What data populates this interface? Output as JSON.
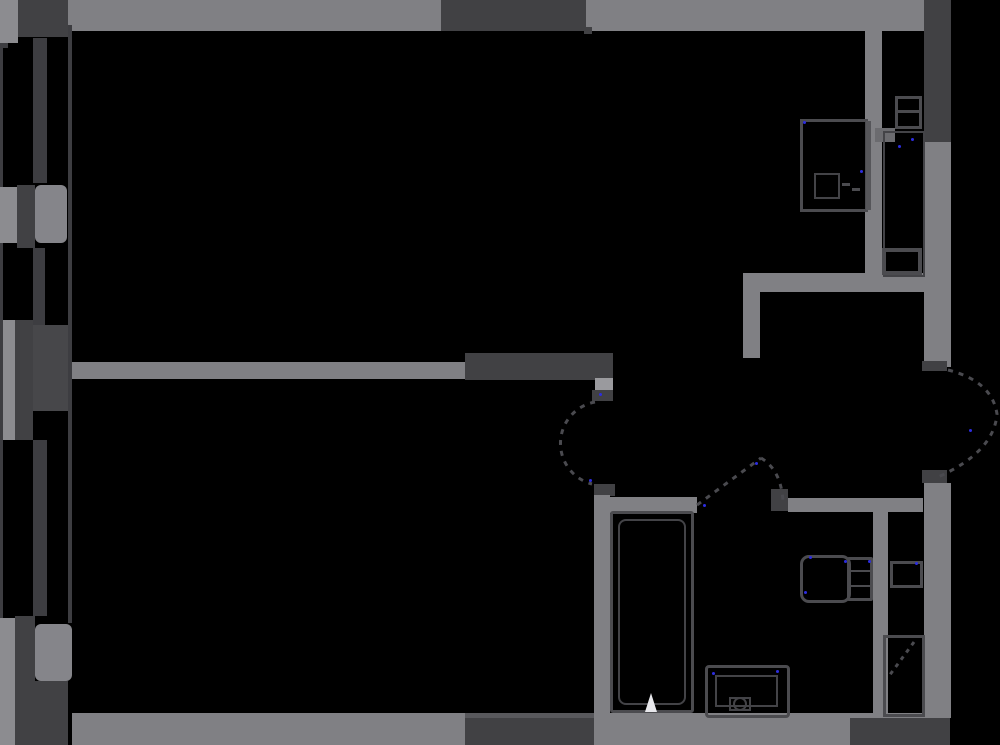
{
  "canvas": {
    "width": 1000,
    "height": 745,
    "background": "#000000"
  },
  "palette": {
    "wall": "#808084",
    "wall_light": "#8c8c90",
    "wall_rounded": "#85858a",
    "window_dark": "#414144",
    "panel_dark": "#47474a",
    "line_dark": "#3d3d41",
    "window_lip": "#58585c",
    "fixture_border": "#4b4b4f",
    "fixture_border2": "#434347",
    "fixture_side": "#56565a",
    "post_light": "#9a9a9e",
    "door_dash": "#4a4a4f",
    "notch": "#6b6b6f",
    "glyph_white": "#e8e8ec",
    "dot_blue": "#2d2de0"
  },
  "elements": [
    {
      "name": "balcony-corner-light",
      "kind": "rect",
      "x": 0,
      "y": 0,
      "w": 18,
      "h": 43,
      "color": "wall_light"
    },
    {
      "name": "balcony-corner-dark",
      "kind": "rect",
      "x": 18,
      "y": 0,
      "w": 50,
      "h": 37,
      "color": "window_dark"
    },
    {
      "name": "top-wall",
      "kind": "rect",
      "x": 68,
      "y": 0,
      "w": 856,
      "h": 31,
      "color": "wall"
    },
    {
      "name": "kitchen-window",
      "kind": "rect",
      "x": 441,
      "y": 0,
      "w": 145,
      "h": 31,
      "color": "window_dark"
    },
    {
      "name": "kitchen-window-latch",
      "kind": "rect",
      "x": 584,
      "y": 27,
      "w": 8,
      "h": 7,
      "color": "window_dark"
    },
    {
      "name": "right-window",
      "kind": "rect",
      "x": 924,
      "y": 0,
      "w": 27,
      "h": 142,
      "color": "window_dark"
    },
    {
      "name": "right-wall-upper",
      "kind": "rect",
      "x": 924,
      "y": 142,
      "w": 27,
      "h": 225,
      "color": "wall"
    },
    {
      "name": "right-wall-lower",
      "kind": "rect",
      "x": 924,
      "y": 483,
      "w": 27,
      "h": 235,
      "color": "wall"
    },
    {
      "name": "bottom-wall",
      "kind": "rect",
      "x": 72,
      "y": 713,
      "w": 878,
      "h": 32,
      "color": "wall"
    },
    {
      "name": "bottom-window-lip",
      "kind": "rect",
      "x": 465,
      "y": 713,
      "w": 140,
      "h": 5,
      "color": "window_lip"
    },
    {
      "name": "bottom-window",
      "kind": "rect",
      "x": 465,
      "y": 718,
      "w": 140,
      "h": 27,
      "color": "window_dark"
    },
    {
      "name": "bottom-right-corner-dark",
      "kind": "rect",
      "x": 850,
      "y": 718,
      "w": 100,
      "h": 27,
      "color": "window_dark"
    },
    {
      "name": "middle-wall",
      "kind": "rect",
      "x": 68,
      "y": 362,
      "w": 397,
      "h": 17,
      "color": "wall"
    },
    {
      "name": "middle-wall-dark-section",
      "kind": "rect",
      "x": 465,
      "y": 353,
      "w": 148,
      "h": 27,
      "color": "window_dark"
    },
    {
      "name": "bedroom-door-jamb-light",
      "kind": "rect",
      "x": 595,
      "y": 378,
      "w": 18,
      "h": 14,
      "color": "post_light"
    },
    {
      "name": "bedroom-door-jamb-dark",
      "kind": "rect",
      "x": 592,
      "y": 390,
      "w": 21,
      "h": 11,
      "color": "window_dark"
    },
    {
      "name": "bedroom-door-bottom-block",
      "kind": "rect",
      "x": 594,
      "y": 484,
      "w": 21,
      "h": 12,
      "color": "window_dark"
    },
    {
      "name": "bedroom-right-wall",
      "kind": "rect",
      "x": 594,
      "y": 495,
      "w": 16,
      "h": 250,
      "color": "wall"
    },
    {
      "name": "hall-bottom-wall-left",
      "kind": "rect",
      "x": 610,
      "y": 497,
      "w": 87,
      "h": 16,
      "color": "wall"
    },
    {
      "name": "bath-door-post",
      "kind": "rect",
      "x": 771,
      "y": 489,
      "w": 17,
      "h": 22,
      "color": "window_dark"
    },
    {
      "name": "hall-bottom-wall-right",
      "kind": "rect",
      "x": 788,
      "y": 498,
      "w": 135,
      "h": 14,
      "color": "wall"
    },
    {
      "name": "shaft-wall",
      "kind": "rect",
      "x": 873,
      "y": 512,
      "w": 15,
      "h": 201,
      "color": "wall"
    },
    {
      "name": "hall-top-wall",
      "kind": "rect",
      "x": 743,
      "y": 273,
      "w": 207,
      "h": 19,
      "color": "wall"
    },
    {
      "name": "hall-wall-stub",
      "kind": "rect",
      "x": 743,
      "y": 292,
      "w": 17,
      "h": 66,
      "color": "wall"
    },
    {
      "name": "kitchen-bath-wall",
      "kind": "rect",
      "x": 865,
      "y": 31,
      "w": 17,
      "h": 245,
      "color": "wall"
    },
    {
      "name": "bath-niche-notch",
      "kind": "rect",
      "x": 875,
      "y": 128,
      "w": 20,
      "h": 14,
      "color": "notch"
    },
    {
      "name": "living-left-wall-line",
      "kind": "rect",
      "x": 68,
      "y": 25,
      "w": 4,
      "h": 598,
      "color": "line_dark"
    },
    {
      "name": "balcony-outer-line",
      "kind": "rect",
      "x": 0,
      "y": 43,
      "w": 3,
      "h": 575,
      "color": "line_dark"
    },
    {
      "name": "balcony-outer-notch",
      "kind": "rect",
      "x": 0,
      "y": 43,
      "w": 8,
      "h": 5,
      "color": "line_dark"
    },
    {
      "name": "balcony-mullion-top",
      "kind": "rect",
      "x": 33,
      "y": 38,
      "w": 14,
      "h": 145,
      "color": "line_dark"
    },
    {
      "name": "balcony-panel1-light",
      "kind": "rect",
      "x": 0,
      "y": 187,
      "w": 17,
      "h": 56,
      "color": "wall_light"
    },
    {
      "name": "balcony-panel1-dark",
      "kind": "rect",
      "x": 17,
      "y": 185,
      "w": 18,
      "h": 63,
      "color": "window_dark"
    },
    {
      "name": "balcony-panel1-rounded",
      "kind": "rect",
      "x": 35,
      "y": 185,
      "w": 32,
      "h": 58,
      "color": "wall_rounded",
      "radius": 6
    },
    {
      "name": "balcony-mullion-mid",
      "kind": "rect",
      "x": 33,
      "y": 248,
      "w": 12,
      "h": 77,
      "color": "line_dark"
    },
    {
      "name": "balcony-door-light",
      "kind": "rect",
      "x": 3,
      "y": 320,
      "w": 12,
      "h": 120,
      "color": "wall_light"
    },
    {
      "name": "balcony-door-dark",
      "kind": "rect",
      "x": 15,
      "y": 320,
      "w": 18,
      "h": 120,
      "color": "window_dark"
    },
    {
      "name": "balcony-door-panel",
      "kind": "rect",
      "x": 33,
      "y": 325,
      "w": 35,
      "h": 86,
      "color": "panel_dark"
    },
    {
      "name": "balcony-mullion-bottom",
      "kind": "rect",
      "x": 33,
      "y": 440,
      "w": 14,
      "h": 176,
      "color": "line_dark"
    },
    {
      "name": "balcony-bottom-light",
      "kind": "rect",
      "x": 0,
      "y": 618,
      "w": 15,
      "h": 127,
      "color": "wall_light"
    },
    {
      "name": "balcony-bottom-dark",
      "kind": "rect",
      "x": 15,
      "y": 616,
      "w": 20,
      "h": 129,
      "color": "window_dark"
    },
    {
      "name": "balcony-bottom-rounded",
      "kind": "rect",
      "x": 35,
      "y": 624,
      "w": 37,
      "h": 57,
      "color": "wall_rounded",
      "radius": 6
    },
    {
      "name": "balcony-bottom-dark2",
      "kind": "rect",
      "x": 35,
      "y": 681,
      "w": 33,
      "h": 64,
      "color": "window_dark"
    },
    {
      "name": "entry-door-block-top",
      "kind": "rect",
      "x": 922,
      "y": 361,
      "w": 25,
      "h": 10,
      "color": "window_dark"
    },
    {
      "name": "entry-door-block-bottom",
      "kind": "rect",
      "x": 922,
      "y": 470,
      "w": 25,
      "h": 13,
      "color": "window_dark"
    },
    {
      "name": "kitchen-unit-outline",
      "kind": "outline",
      "x": 800,
      "y": 119,
      "w": 68,
      "h": 93,
      "color": "fixture_border",
      "bw": 3
    },
    {
      "name": "kitchen-unit-side",
      "kind": "rect",
      "x": 866,
      "y": 121,
      "w": 5,
      "h": 89,
      "color": "fixture_side"
    },
    {
      "name": "kitchen-unit-inner",
      "kind": "outline",
      "x": 814,
      "y": 173,
      "w": 26,
      "h": 26,
      "color": "fixture_border2",
      "bw": 2
    },
    {
      "name": "kitchen-unit-dash-a",
      "kind": "rect",
      "x": 842,
      "y": 183,
      "w": 8,
      "h": 3,
      "color": "fixture_border"
    },
    {
      "name": "kitchen-unit-dash-b",
      "kind": "rect",
      "x": 852,
      "y": 188,
      "w": 8,
      "h": 3,
      "color": "fixture_border"
    },
    {
      "name": "washbasin-top-outline",
      "kind": "outline",
      "x": 895,
      "y": 96,
      "w": 27,
      "h": 33,
      "color": "fixture_border",
      "bw": 3
    },
    {
      "name": "washbasin-top-line",
      "kind": "rect",
      "x": 896,
      "y": 110,
      "w": 25,
      "h": 3,
      "color": "fixture_border"
    },
    {
      "name": "shower-tall-outline",
      "kind": "outline",
      "x": 883,
      "y": 131,
      "w": 42,
      "h": 146,
      "color": "fixture_border2",
      "bw": 2
    },
    {
      "name": "shower-bottom-box",
      "kind": "outline",
      "x": 882,
      "y": 248,
      "w": 40,
      "h": 27,
      "color": "fixture_border",
      "bw": 4
    },
    {
      "name": "bathtub-outer",
      "kind": "outline",
      "x": 610,
      "y": 511,
      "w": 84,
      "h": 202,
      "color": "fixture_border",
      "bw": 3,
      "radius": 3
    },
    {
      "name": "bathtub-inner",
      "kind": "outline",
      "x": 618,
      "y": 519,
      "w": 68,
      "h": 186,
      "color": "fixture_border2",
      "bw": 2,
      "radius": 8
    },
    {
      "name": "toilet-bowl",
      "kind": "outline",
      "x": 800,
      "y": 555,
      "w": 51,
      "h": 48,
      "color": "fixture_border",
      "bw": 3,
      "radius": 9
    },
    {
      "name": "toilet-tank",
      "kind": "outline",
      "x": 847,
      "y": 557,
      "w": 26,
      "h": 44,
      "color": "fixture_border",
      "bw": 3,
      "radius": 2
    },
    {
      "name": "toilet-tank-line-a",
      "kind": "rect",
      "x": 850,
      "y": 570,
      "w": 20,
      "h": 2,
      "color": "fixture_border"
    },
    {
      "name": "toilet-tank-line-b",
      "kind": "rect",
      "x": 850,
      "y": 585,
      "w": 20,
      "h": 2,
      "color": "fixture_border"
    },
    {
      "name": "sink-outer",
      "kind": "outline",
      "x": 705,
      "y": 665,
      "w": 85,
      "h": 53,
      "color": "fixture_border",
      "bw": 3,
      "radius": 4
    },
    {
      "name": "sink-inner",
      "kind": "outline",
      "x": 715,
      "y": 675,
      "w": 63,
      "h": 32,
      "color": "fixture_border2",
      "bw": 2
    },
    {
      "name": "sink-drain-box",
      "kind": "outline",
      "x": 729,
      "y": 697,
      "w": 22,
      "h": 14,
      "color": "fixture_border2",
      "bw": 2
    },
    {
      "name": "shaft-box",
      "kind": "outline",
      "x": 890,
      "y": 561,
      "w": 33,
      "h": 27,
      "color": "fixture_border",
      "bw": 3
    },
    {
      "name": "shaft-door-outline",
      "kind": "outline",
      "x": 883,
      "y": 635,
      "w": 42,
      "h": 82,
      "color": "fixture_border",
      "bw": 3
    }
  ],
  "paths": [
    {
      "name": "bedroom-door-arc",
      "d": "M 595 402 A 42 42 0 0 0 592 484",
      "stroke": "door_dash",
      "w": 3,
      "dash": "5 6"
    },
    {
      "name": "bath-door-leaf",
      "d": "M 697 505 L 761 458",
      "stroke": "door_dash",
      "w": 3,
      "dash": "5 6"
    },
    {
      "name": "bath-door-arc",
      "d": "M 761 458 Q 781 470 783 501",
      "stroke": "door_dash",
      "w": 3,
      "dash": "5 6"
    },
    {
      "name": "entry-door-arc",
      "d": "M 948 370 Q 992 381 997 414 Q 994 452 938 477",
      "stroke": "door_dash",
      "w": 3,
      "dash": "5 6"
    },
    {
      "name": "shaft-door-swing",
      "d": "M 914 642 L 889 676",
      "stroke": "door_dash",
      "w": 3,
      "dash": "4 5"
    },
    {
      "name": "bathtub-drain-icon",
      "d": "M 645 712 L 651 693 L 657 712 Z",
      "fill": "glyph_white"
    },
    {
      "name": "sink-drain-icon",
      "d": "M 734 704 a 6 6 0 1 0 12 0 a 6 6 0 1 0 -12 0",
      "stroke": "fixture_border2",
      "w": 2
    }
  ],
  "hinge_dots": [
    [
      804,
      122
    ],
    [
      861,
      171
    ],
    [
      912,
      139
    ],
    [
      899,
      146
    ],
    [
      810,
      557
    ],
    [
      845,
      561
    ],
    [
      869,
      561
    ],
    [
      805,
      592
    ],
    [
      713,
      673
    ],
    [
      777,
      671
    ],
    [
      916,
      563
    ],
    [
      590,
      480
    ],
    [
      704,
      505
    ],
    [
      970,
      430
    ],
    [
      756,
      463
    ],
    [
      600,
      394
    ]
  ]
}
